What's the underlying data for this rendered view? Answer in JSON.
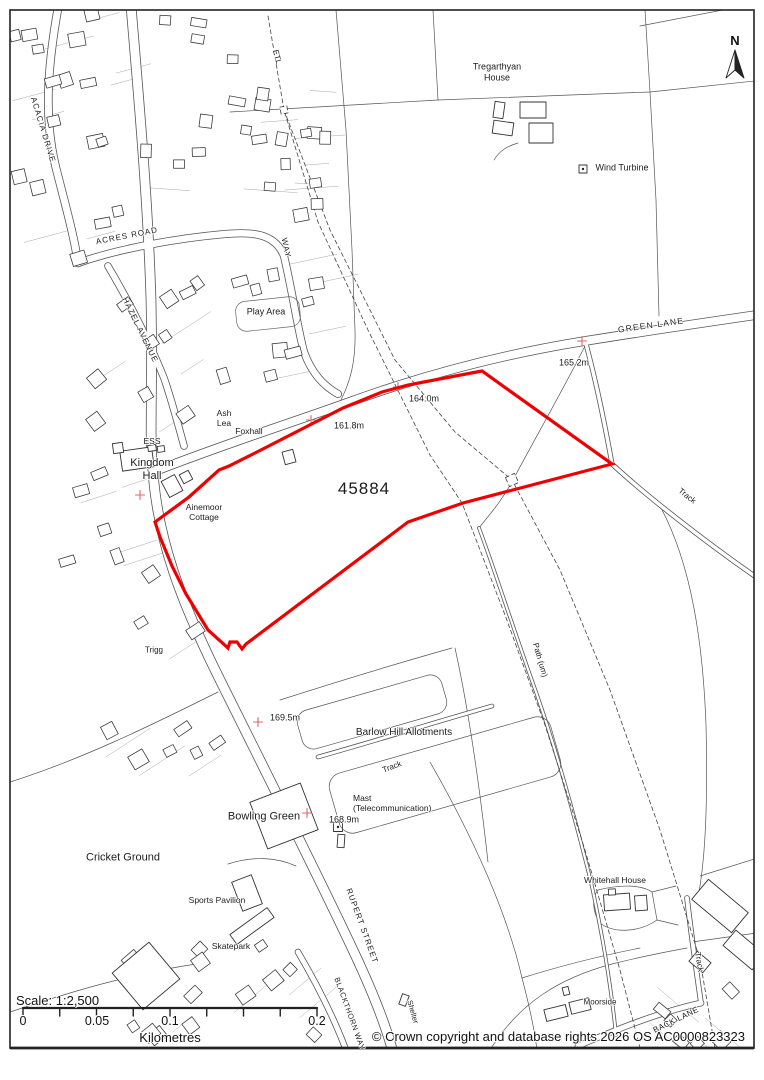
{
  "map": {
    "north_label": "N",
    "site_number": "45884",
    "site_outline_color": "#ee0000",
    "spot_cross_color": "#e06565",
    "labels": [
      {
        "id": "tregarthyan-house",
        "text": "Tregarthyan\nHouse",
        "x": 497,
        "y": 72,
        "rot": 0,
        "size": 9,
        "align": "c"
      },
      {
        "id": "wind-turbine",
        "text": "Wind Turbine",
        "x": 622,
        "y": 168,
        "rot": 0,
        "size": 9,
        "align": "c"
      },
      {
        "id": "etl",
        "text": "ETL",
        "x": 277,
        "y": 57,
        "rot": 75,
        "size": 8,
        "align": "c"
      },
      {
        "id": "green-lane",
        "text": "GREEN LANE",
        "x": 651,
        "y": 325,
        "rot": -8,
        "size": 8.5,
        "ls": 1.2,
        "align": "c"
      },
      {
        "id": "spot-165",
        "text": "165.2m",
        "x": 574,
        "y": 363,
        "rot": 0,
        "size": 9,
        "align": "c"
      },
      {
        "id": "spot-164",
        "text": "164.0m",
        "x": 424,
        "y": 399,
        "rot": 0,
        "size": 9,
        "align": "c"
      },
      {
        "id": "spot-161",
        "text": "161.8m",
        "x": 349,
        "y": 426,
        "rot": 0,
        "size": 9,
        "align": "c"
      },
      {
        "id": "ash-lea",
        "text": "Ash\nLea",
        "x": 224,
        "y": 418,
        "rot": 0,
        "size": 8.5,
        "align": "c"
      },
      {
        "id": "foxhall",
        "text": "Foxhall",
        "x": 249,
        "y": 431,
        "rot": 0,
        "size": 8.5,
        "align": "c"
      },
      {
        "id": "ess",
        "text": "ESS",
        "x": 152,
        "y": 441,
        "rot": 0,
        "size": 8.5,
        "align": "c"
      },
      {
        "id": "kingdom-hall",
        "text": "Kingdom\nHall",
        "x": 152,
        "y": 470,
        "rot": 0,
        "size": 11,
        "align": "c"
      },
      {
        "id": "site-number",
        "text": "45884",
        "x": 364,
        "y": 489,
        "rot": 0,
        "size": 17,
        "ls": 1,
        "align": "c"
      },
      {
        "id": "ainemoor-cottage",
        "text": "Ainemoor\nCottage",
        "x": 204,
        "y": 512,
        "rot": 0,
        "size": 8.5,
        "align": "c"
      },
      {
        "id": "play-area",
        "text": "Play Area",
        "x": 266,
        "y": 312,
        "rot": 0,
        "size": 9,
        "align": "c"
      },
      {
        "id": "acacia-drive",
        "text": "ACACIA DRIVE",
        "x": 43,
        "y": 130,
        "rot": 73,
        "size": 8,
        "ls": 1,
        "align": "c"
      },
      {
        "id": "acres-road",
        "text": "ACRES ROAD",
        "x": 127,
        "y": 236,
        "rot": -11,
        "size": 8,
        "ls": 1,
        "align": "c"
      },
      {
        "id": "hazel-avenue",
        "text": "HAZEL AVENUE",
        "x": 140,
        "y": 330,
        "rot": 64,
        "size": 8,
        "ls": 1,
        "align": "c"
      },
      {
        "id": "way",
        "text": "WAY",
        "x": 286,
        "y": 248,
        "rot": 78,
        "size": 8,
        "ls": 1,
        "align": "c"
      },
      {
        "id": "track-east",
        "text": "Track",
        "x": 687,
        "y": 496,
        "rot": 38,
        "size": 8,
        "align": "c"
      },
      {
        "id": "path-um",
        "text": "Path (um)",
        "x": 540,
        "y": 660,
        "rot": 74,
        "size": 8,
        "align": "c"
      },
      {
        "id": "spot-169",
        "text": "169.5m",
        "x": 285,
        "y": 718,
        "rot": 0,
        "size": 9,
        "align": "c"
      },
      {
        "id": "allotments",
        "text": "Barlow Hill Allotments",
        "x": 404,
        "y": 733,
        "rot": 0,
        "size": 10,
        "align": "c"
      },
      {
        "id": "track-allotments",
        "text": "Track",
        "x": 392,
        "y": 767,
        "rot": -21,
        "size": 8,
        "align": "c"
      },
      {
        "id": "mast",
        "text": "Mast\n(Telecommunication)",
        "x": 353,
        "y": 803,
        "rot": 0,
        "size": 8.5,
        "align": "l"
      },
      {
        "id": "spot-168",
        "text": "168.9m",
        "x": 344,
        "y": 820,
        "rot": 0,
        "size": 9,
        "align": "c"
      },
      {
        "id": "bowling-green",
        "text": "Bowling Green",
        "x": 264,
        "y": 817,
        "rot": 0,
        "size": 11,
        "align": "c"
      },
      {
        "id": "cricket-ground",
        "text": "Cricket Ground",
        "x": 123,
        "y": 858,
        "rot": 0,
        "size": 11,
        "align": "c"
      },
      {
        "id": "sports-pavilion",
        "text": "Sports Pavilion",
        "x": 217,
        "y": 900,
        "rot": 0,
        "size": 8.5,
        "align": "c"
      },
      {
        "id": "skatepark",
        "text": "Skatepark",
        "x": 231,
        "y": 946,
        "rot": 0,
        "size": 8.5,
        "align": "c"
      },
      {
        "id": "whitehall-house",
        "text": "Whitehall House",
        "x": 615,
        "y": 880,
        "rot": 0,
        "size": 8.5,
        "align": "c"
      },
      {
        "id": "moorside",
        "text": "Moorside",
        "x": 600,
        "y": 1002,
        "rot": 0,
        "size": 8,
        "align": "c"
      },
      {
        "id": "back-lane",
        "text": "BACK LANE",
        "x": 676,
        "y": 1020,
        "rot": -26,
        "size": 8,
        "ls": 0.5,
        "align": "c"
      },
      {
        "id": "track-south",
        "text": "Track",
        "x": 699,
        "y": 962,
        "rot": 80,
        "size": 8,
        "align": "c"
      },
      {
        "id": "rupert-street",
        "text": "RUPERT STREET",
        "x": 362,
        "y": 926,
        "rot": 70,
        "size": 8,
        "ls": 1,
        "align": "c"
      },
      {
        "id": "blackthorn-way",
        "text": "BLACKTHORN WAY",
        "x": 349,
        "y": 1014,
        "rot": 70,
        "size": 7.5,
        "ls": 0.5,
        "align": "c"
      },
      {
        "id": "shelter",
        "text": "Shelter",
        "x": 412,
        "y": 1012,
        "rot": 74,
        "size": 7.5,
        "align": "c"
      },
      {
        "id": "trigg",
        "text": "Trigg",
        "x": 154,
        "y": 650,
        "rot": 0,
        "size": 8,
        "align": "c"
      }
    ]
  },
  "scalebar": {
    "title": "Scale: 1:2,500",
    "unit": "Kilometres",
    "ticks": [
      "0",
      "0.05",
      "0.1",
      "0.2"
    ]
  },
  "footer": {
    "copyright": "© Crown copyright and database rights 2026 OS AC0000823323"
  }
}
